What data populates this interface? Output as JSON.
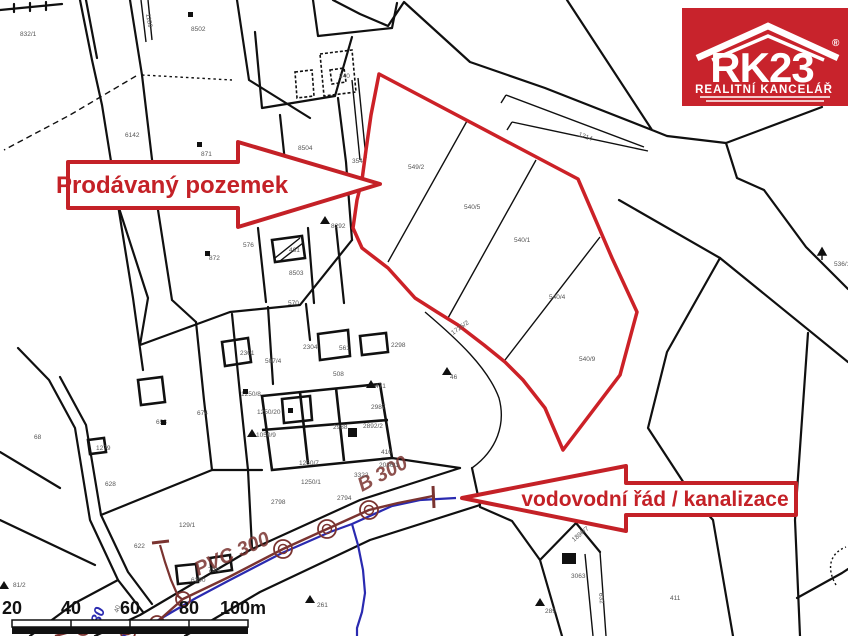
{
  "branding": {
    "name": "RK23",
    "registered": "®",
    "tagline": "REALITNÍ KANCELÁŘ",
    "bg_color": "#c8232c"
  },
  "callouts": {
    "sold_parcel": "Prodávaný pozemek",
    "utilities": "vodovodní řád / kanalizace",
    "arrow_color": "#c42127"
  },
  "scale_bar": {
    "labels": [
      "20",
      "40",
      "60",
      "80",
      "100m"
    ]
  },
  "map": {
    "red_outline_color": "#cc2127",
    "water_color": "#2a2ab0",
    "sewer_color": "#7a3330",
    "red_parcel_outline": [
      [
        379,
        74
      ],
      [
        578,
        179
      ],
      [
        612,
        258
      ],
      [
        637,
        312
      ],
      [
        620,
        375
      ],
      [
        563,
        450
      ],
      [
        545,
        408
      ],
      [
        523,
        380
      ],
      [
        505,
        362
      ],
      [
        484,
        345
      ],
      [
        458,
        325
      ],
      [
        437,
        312
      ],
      [
        415,
        298
      ],
      [
        388,
        268
      ],
      [
        362,
        248
      ],
      [
        353,
        228
      ],
      [
        357,
        200
      ],
      [
        362,
        180
      ],
      [
        366,
        150
      ],
      [
        371,
        115
      ]
    ],
    "water_line_main": [
      [
        456,
        498
      ],
      [
        420,
        500
      ],
      [
        392,
        506
      ],
      [
        352,
        524
      ],
      [
        330,
        532
      ],
      [
        282,
        553
      ],
      [
        228,
        581
      ],
      [
        196,
        598
      ],
      [
        172,
        612
      ],
      [
        150,
        625
      ],
      [
        122,
        636
      ]
    ],
    "water_line_branch": [
      [
        352,
        524
      ],
      [
        358,
        545
      ],
      [
        363,
        570
      ],
      [
        365,
        593
      ],
      [
        362,
        612
      ],
      [
        357,
        628
      ],
      [
        357,
        636
      ]
    ],
    "sewer_line_main": [
      [
        433,
        496
      ],
      [
        398,
        503
      ],
      [
        369,
        510
      ],
      [
        327,
        529
      ],
      [
        283,
        549
      ],
      [
        229,
        577
      ],
      [
        183,
        599
      ],
      [
        157,
        622
      ],
      [
        128,
        634
      ],
      [
        85,
        628
      ],
      [
        55,
        636
      ]
    ],
    "sewer_line_branch": [
      [
        160,
        545
      ],
      [
        165,
        562
      ],
      [
        171,
        580
      ],
      [
        178,
        596
      ],
      [
        183,
        600
      ]
    ],
    "manholes": [
      [
        369,
        510
      ],
      [
        327,
        529
      ],
      [
        283,
        549
      ],
      [
        183,
        599
      ],
      [
        157,
        623
      ],
      [
        128,
        633
      ],
      [
        83,
        628
      ]
    ],
    "pipe_labels": [
      {
        "t": "PVC 300",
        "x": 198,
        "y": 576,
        "r": -24
      },
      {
        "t": "B 300",
        "x": 362,
        "y": 492,
        "r": -28
      }
    ],
    "water_label": {
      "t": "80",
      "x": 100,
      "y": 625,
      "r": -72
    },
    "parcel_labels": [
      {
        "t": "832/1",
        "x": 20,
        "y": 36
      },
      {
        "t": "1189",
        "x": 146,
        "y": 14,
        "r": 80
      },
      {
        "t": "8502",
        "x": 191,
        "y": 31
      },
      {
        "t": "6142",
        "x": 125,
        "y": 137
      },
      {
        "t": "871",
        "x": 201,
        "y": 156
      },
      {
        "t": "240",
        "x": 339,
        "y": 78
      },
      {
        "t": "8504",
        "x": 298,
        "y": 150
      },
      {
        "t": "354",
        "x": 352,
        "y": 163
      },
      {
        "t": "8292",
        "x": 331,
        "y": 228
      },
      {
        "t": "576",
        "x": 243,
        "y": 247
      },
      {
        "t": "872",
        "x": 209,
        "y": 260
      },
      {
        "t": "461",
        "x": 289,
        "y": 252
      },
      {
        "t": "8503",
        "x": 289,
        "y": 275
      },
      {
        "t": "570",
        "x": 288,
        "y": 305
      },
      {
        "t": "1214",
        "x": 578,
        "y": 136,
        "r": 20
      },
      {
        "t": "549/2",
        "x": 408,
        "y": 169
      },
      {
        "t": "540/5",
        "x": 464,
        "y": 209
      },
      {
        "t": "540/1",
        "x": 514,
        "y": 242
      },
      {
        "t": "540/4",
        "x": 549,
        "y": 299
      },
      {
        "t": "540/9",
        "x": 579,
        "y": 361
      },
      {
        "t": "1725/2",
        "x": 453,
        "y": 335,
        "r": -35
      },
      {
        "t": "2301",
        "x": 240,
        "y": 355
      },
      {
        "t": "507/4",
        "x": 265,
        "y": 363
      },
      {
        "t": "2304",
        "x": 303,
        "y": 349
      },
      {
        "t": "561",
        "x": 339,
        "y": 350
      },
      {
        "t": "2298",
        "x": 391,
        "y": 347
      },
      {
        "t": "508",
        "x": 333,
        "y": 376
      },
      {
        "t": "471",
        "x": 375,
        "y": 388
      },
      {
        "t": "46",
        "x": 450,
        "y": 379
      },
      {
        "t": "674",
        "x": 197,
        "y": 415
      },
      {
        "t": "1250/8",
        "x": 241,
        "y": 396
      },
      {
        "t": "693",
        "x": 156,
        "y": 424
      },
      {
        "t": "1250/20",
        "x": 257,
        "y": 414
      },
      {
        "t": "1050/9",
        "x": 256,
        "y": 437
      },
      {
        "t": "2987",
        "x": 371,
        "y": 409
      },
      {
        "t": "2988",
        "x": 333,
        "y": 429
      },
      {
        "t": "2892/2",
        "x": 363,
        "y": 428
      },
      {
        "t": "410",
        "x": 381,
        "y": 454
      },
      {
        "t": "3322",
        "x": 354,
        "y": 477
      },
      {
        "t": "2036/1",
        "x": 379,
        "y": 467
      },
      {
        "t": "1250/7",
        "x": 299,
        "y": 465
      },
      {
        "t": "1250/1",
        "x": 301,
        "y": 484
      },
      {
        "t": "2798",
        "x": 271,
        "y": 504
      },
      {
        "t": "2794",
        "x": 337,
        "y": 500
      },
      {
        "t": "129/1",
        "x": 179,
        "y": 527
      },
      {
        "t": "6390",
        "x": 191,
        "y": 582
      },
      {
        "t": "79/1",
        "x": 208,
        "y": 572
      },
      {
        "t": "261",
        "x": 317,
        "y": 607
      },
      {
        "t": "68",
        "x": 34,
        "y": 439
      },
      {
        "t": "1279",
        "x": 96,
        "y": 450
      },
      {
        "t": "628",
        "x": 105,
        "y": 486
      },
      {
        "t": "622",
        "x": 134,
        "y": 548
      },
      {
        "t": "81/2",
        "x": 13,
        "y": 587
      },
      {
        "t": "1896/7",
        "x": 574,
        "y": 542,
        "r": -40
      },
      {
        "t": "3063",
        "x": 571,
        "y": 578
      },
      {
        "t": "289",
        "x": 545,
        "y": 613
      },
      {
        "t": "411",
        "x": 670,
        "y": 600
      },
      {
        "t": "536/1",
        "x": 834,
        "y": 266
      },
      {
        "t": "632",
        "x": 599,
        "y": 593,
        "r": 85
      },
      {
        "t": "40",
        "x": 118,
        "y": 613,
        "r": -72
      }
    ],
    "symbols": {
      "triangles": [
        [
          325,
          216
        ],
        [
          371,
          380
        ],
        [
          252,
          429
        ],
        [
          310,
          595
        ],
        [
          540,
          598
        ],
        [
          4,
          581
        ],
        [
          447,
          367
        ]
      ],
      "squares": [
        [
          188,
          12
        ],
        [
          197,
          142
        ],
        [
          205,
          251
        ],
        [
          243,
          389
        ],
        [
          161,
          420
        ],
        [
          288,
          408
        ]
      ],
      "tree": [
        822,
        248
      ]
    },
    "scale_label_xs": [
      12,
      71,
      130,
      189,
      243
    ]
  }
}
